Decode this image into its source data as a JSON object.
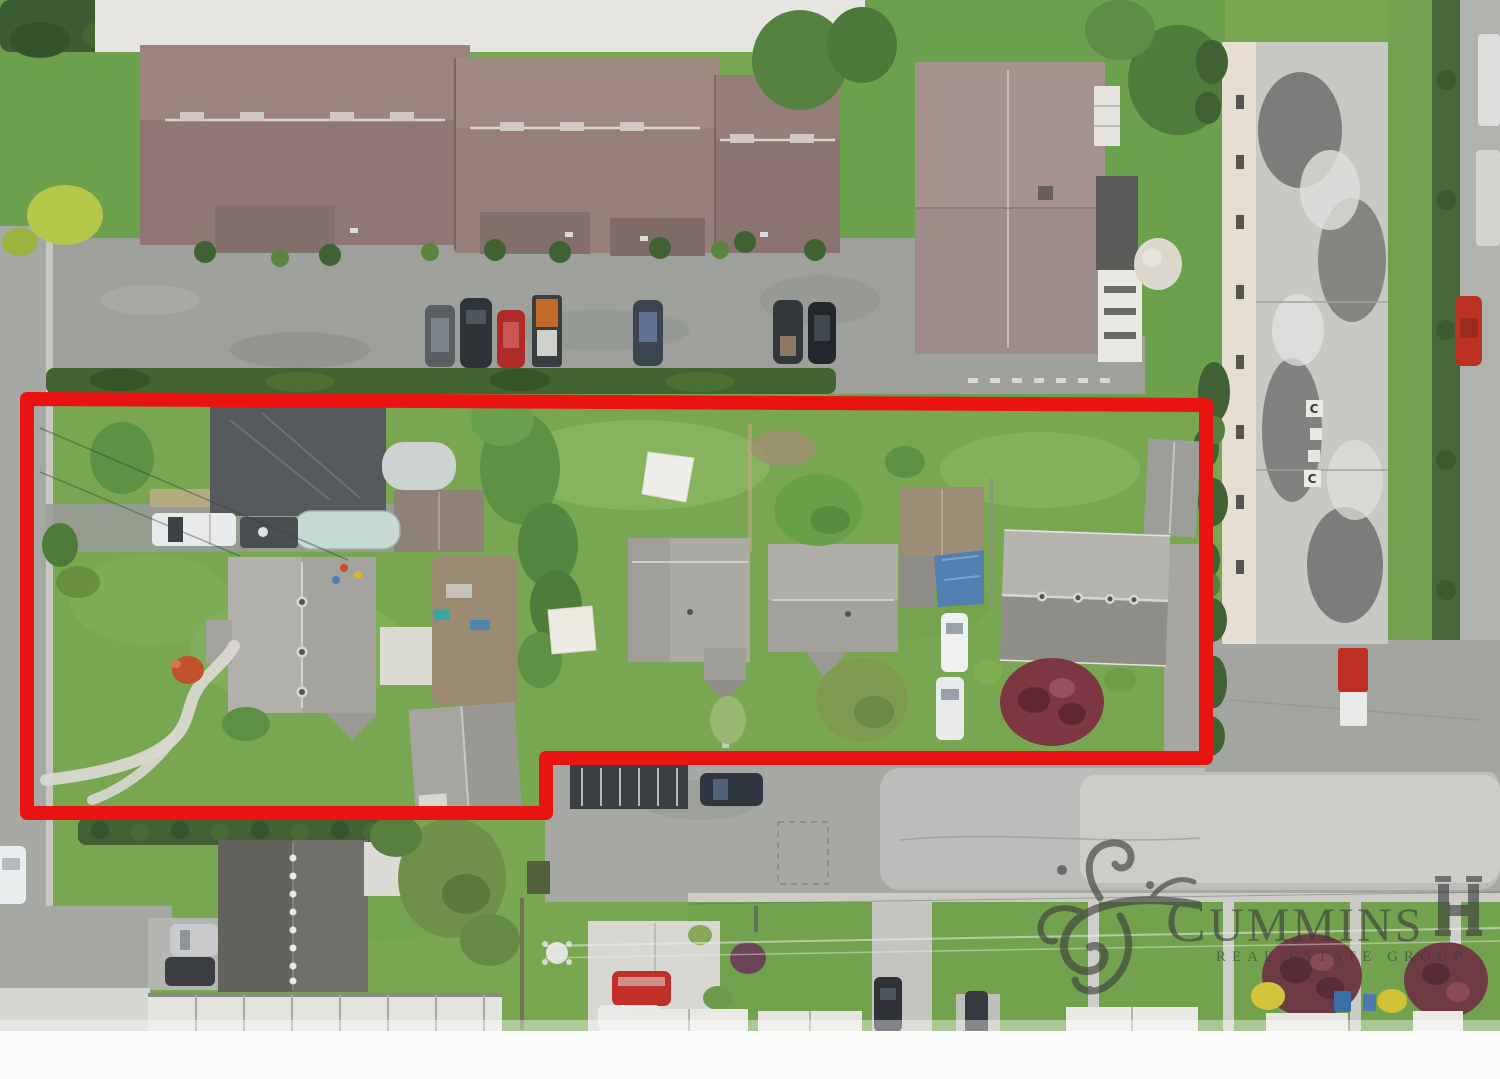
{
  "watermark": {
    "brand": "CUMMINS",
    "brand_initial": "C",
    "brand_rest": "UMMINS",
    "subtitle": "REAL ESTATE GROUP",
    "color": "#3b3b3b"
  },
  "boundary": {
    "color": "#e91311",
    "shape": "stepped rectangle outlining the listed property lots"
  },
  "roof_markings": {
    "c1": "C",
    "c2": "C"
  },
  "palette": {
    "grass": "#79a751",
    "asphalt": "#a6a8a4",
    "townhouse_roof": "#8f7874",
    "house_roof_gray": "#aba9a4",
    "tarp_blue": "#517fb0",
    "maple_red": "#7c3742",
    "hedge_green": "#3f6134"
  }
}
